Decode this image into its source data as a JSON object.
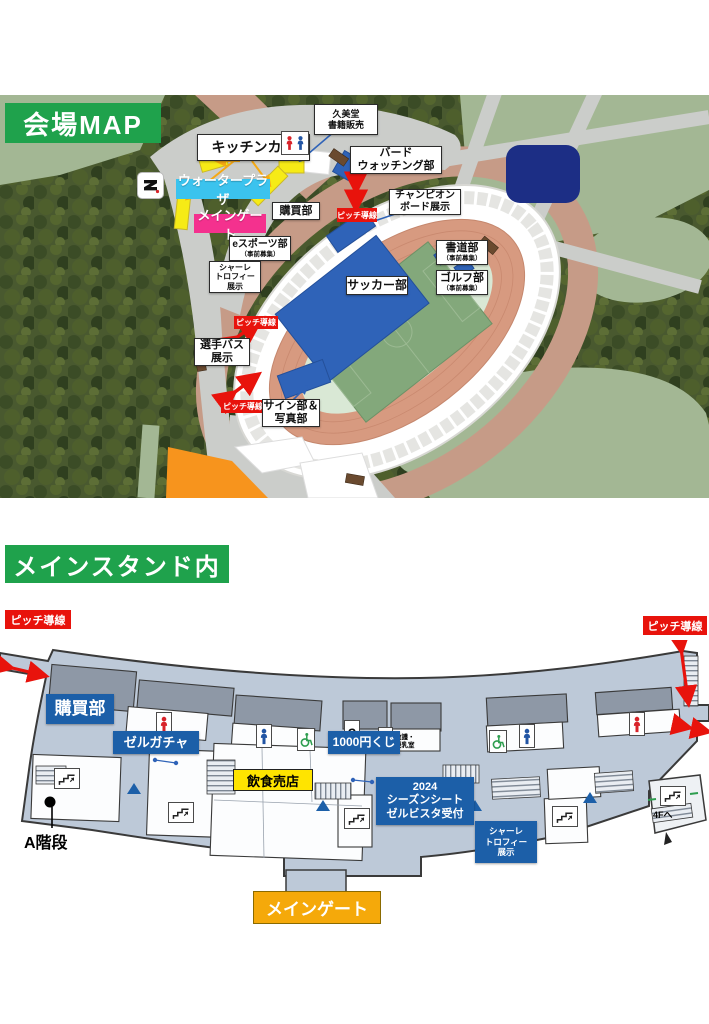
{
  "venue_map": {
    "title": "会場MAP",
    "kitchen_car": "キッチンカー",
    "kumido": [
      "久美堂",
      "書籍販売"
    ],
    "bird": [
      "バード",
      "ウォッチング部"
    ],
    "champion": [
      "チャンピオン",
      "ボード展示"
    ],
    "calligraphy": "書道部",
    "golf": "ゴルフ部",
    "esports": "eスポーツ部",
    "recruit_note": "（事前募集）",
    "schale": [
      "シャーレ",
      "トロフィー",
      "展示"
    ],
    "soccer": "サッカー部",
    "player_bus": [
      "選手バス",
      "展示"
    ],
    "sign_photo": [
      "サイン部＆",
      "写真部"
    ],
    "kobai": "購買部",
    "water_plaza": "ウォータープラザ",
    "main_gate": "メインゲート",
    "pitch_route": "ピッチ導線"
  },
  "main_stand": {
    "title": "メインスタンド内",
    "pitch_route": "ピッチ導線",
    "kobai": "購買部",
    "zelgacha": "ゼルガチャ",
    "lottery": "1000円くじ",
    "food_shop": "飲食売店",
    "season_seat": [
      "2024",
      "シーズンシート",
      "ゼルビスタ受付"
    ],
    "schale": [
      "シャーレ",
      "トロフィー",
      "展示"
    ],
    "first_aid": "救護・授乳室",
    "question_mark": "?",
    "a_stairs": "A階段",
    "to_4f": "4Fへ",
    "main_gate": "メインゲート"
  },
  "colors": {
    "header_green": "#1fa24c",
    "label_blue": "#1c5fa8",
    "red": "#e8130c",
    "cyan": "#3bc3ee",
    "pink": "#f4318e",
    "yellow": "#ffe400",
    "gate_orange": "#f5a90a",
    "navy_building": "#1c2e85"
  }
}
